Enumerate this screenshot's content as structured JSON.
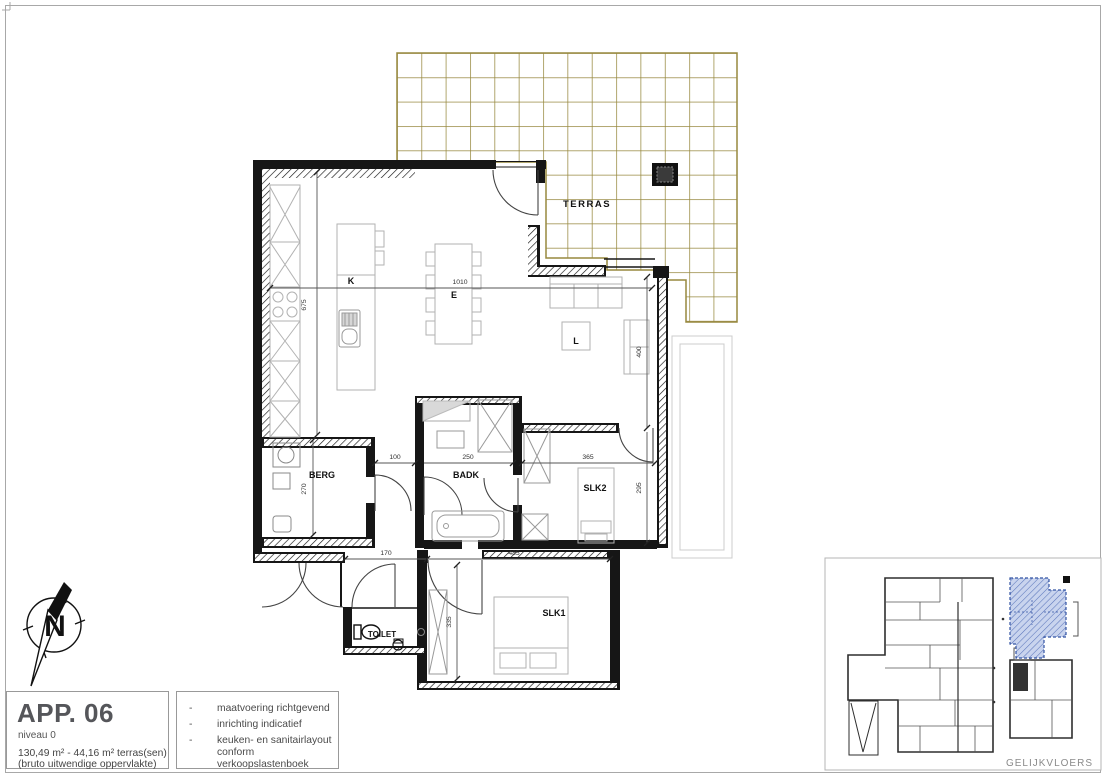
{
  "rooms": {
    "kitchen": "K",
    "dining": "E",
    "living": "L",
    "storage": "BERG",
    "bathroom": "BADK",
    "bedroom2": "SLK2",
    "bedroom1": "SLK1",
    "toilet": "TOILET",
    "terrace": "TERRAS"
  },
  "dimensions": {
    "living_width": "1010",
    "kitchen_height": "675",
    "living_right": "400",
    "bedroom2_right": "295",
    "hall_width": "100",
    "bathroom_width": "250",
    "bedroom2_width": "365",
    "storage_height": "270",
    "entry_width": "170",
    "bedroom1_width": "485",
    "bedroom1_height": "335"
  },
  "compass": {
    "north_label": "N"
  },
  "title_block": {
    "apartment": "APP. 06",
    "level": "niveau 0",
    "area_line": "130,49 m² - 44,16 m² terras(sen)",
    "area_note": "(bruto uitwendige oppervlakte)"
  },
  "notes": {
    "bullet": "-",
    "items": [
      "maatvoering richtgevend",
      "inrichting indicatief",
      "keuken- en sanitairlayout conform verkoopslastenboek"
    ]
  },
  "overview": {
    "caption": "GELIJKVLOERS"
  },
  "colors": {
    "tile_line": "#97883f",
    "wall": "#161616",
    "furniture_line": "#b2b2b2",
    "dimension_line": "#555555",
    "highlight_fill": "#c9d4ee",
    "highlight_stroke": "#3353a4",
    "title_text": "#55565a",
    "caption_text": "#8a8a8a"
  }
}
